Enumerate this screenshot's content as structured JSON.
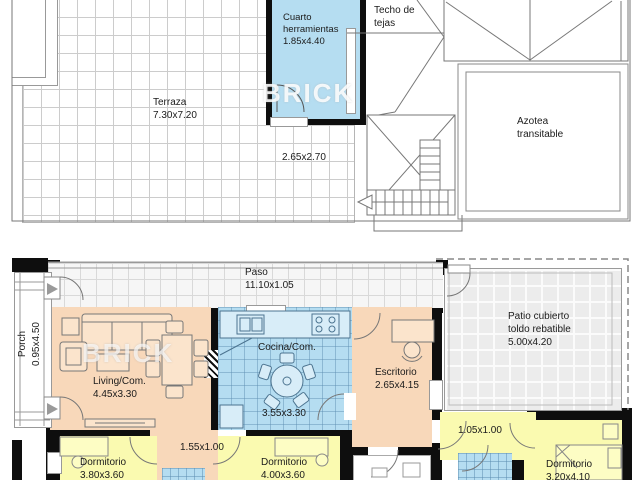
{
  "watermark": "BRICK",
  "upper_floor": {
    "terraza": {
      "name": "Terraza",
      "dims": "7.30x7.20"
    },
    "cuarto_herramientas": {
      "line1": "Cuarto",
      "line2": "herramientas",
      "dims": "1.85x4.40"
    },
    "techo_tejas": {
      "line1": "Techo de",
      "line2": "tejas"
    },
    "azotea": {
      "line1": "Azotea",
      "line2": "transitable"
    },
    "hueco_escalera": {
      "dims": "2.65x2.70"
    }
  },
  "lower_floor": {
    "paso": {
      "name": "Paso",
      "dims": "11.10x1.05"
    },
    "porch": {
      "name": "Porch",
      "dims": "0.95x4.50"
    },
    "living": {
      "name": "Living/Com.",
      "dims": "4.45x3.30"
    },
    "cocina": {
      "name": "Cocina/Com.",
      "dims": "3.55x3.30"
    },
    "escritorio": {
      "name": "Escritorio",
      "dims": "2.65x4.15"
    },
    "patio": {
      "line1": "Patio cubierto",
      "line2": "toldo rebatible",
      "dims": "5.00x4.20"
    },
    "hall_center": {
      "dims": "1.55x1.00"
    },
    "hall_right": {
      "dims": "1.05x1.00"
    },
    "dormitorio1": {
      "name": "Dormitorio",
      "dims": "3.80x3.60"
    },
    "dormitorio2": {
      "name": "Dormitorio",
      "dims": "4.00x3.60"
    },
    "dormitorio3": {
      "name": "Dormitorio",
      "dims": "3.20x4.10"
    }
  },
  "colors": {
    "wall": "#0e0e0e",
    "wet_room_blue": "#b5ddf1",
    "living_peach": "#f8d8ba",
    "bedroom_yellow": "#fafab0",
    "tile_gray": "#ececec"
  }
}
